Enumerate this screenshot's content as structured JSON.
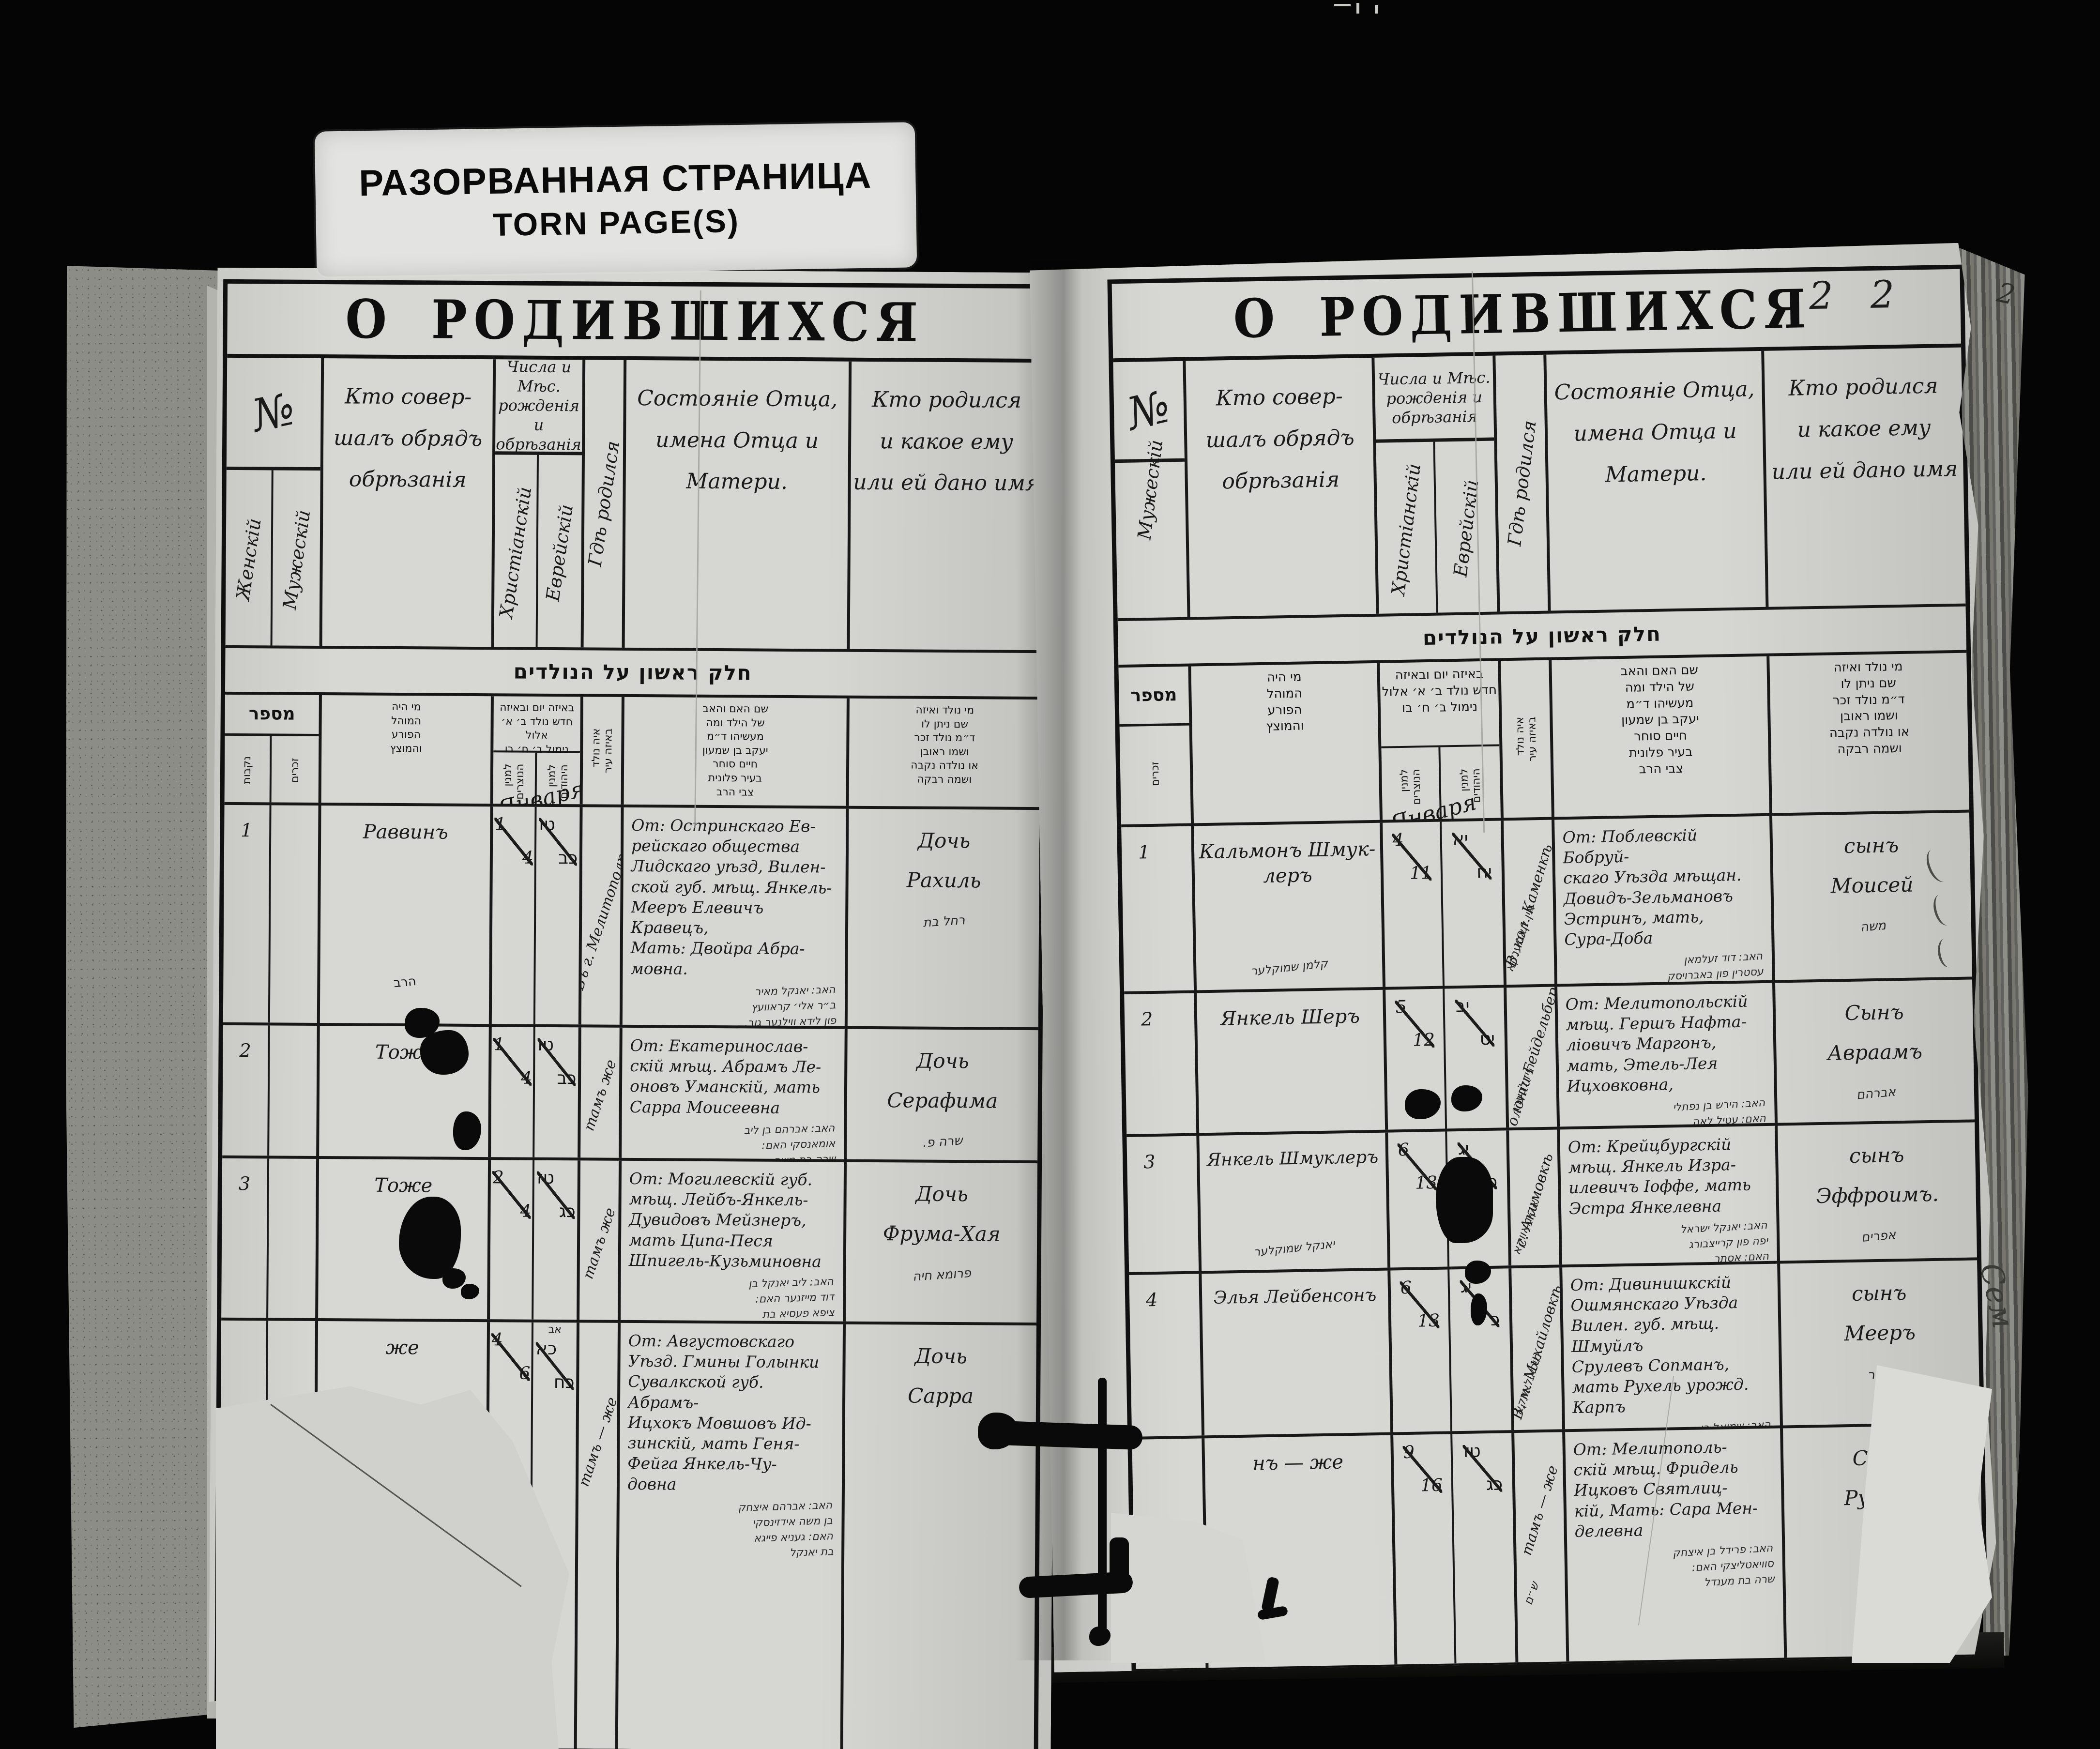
{
  "window_label": {
    "line1": "РАЗОРВАННАЯ СТРАНИЦА",
    "line2": "TORN PAGE(S)"
  },
  "titles": {
    "left": "О РОДИВШИХСЯ",
    "right": "О РОДИВШИХСЯ",
    "page_number": "2 2",
    "edge_number": "2",
    "margin_note": "Сем"
  },
  "columns": {
    "num_symbol": "№",
    "female": "Женскій",
    "male": "Мужескій",
    "performer": "Кто совер-\nшалъ обрядъ\nобрѣзанія",
    "dates": "Числа и Мѣс.\nрожденія и\nобрѣзанія",
    "date_christian": "Христіанскій",
    "date_jewish": "Еврейскій",
    "where": "Гдѣ родился",
    "parents": "Состояніе Отца,\nимена Отца и\nМатери.",
    "child": "Кто родился\nи какое ему\nили ей дано имя"
  },
  "hebrew": {
    "band": "חלק ראשון על הנולדים",
    "num": "מספר",
    "female": "נקבות",
    "male": "זכרים",
    "performer": "מי היה\nהמוהל\nהפורע\nוהמוצץ",
    "dates": "באיזה יום ובאיזה\nחדש נולד ב׳ א׳ אלול\nנימול ב׳ ח׳ בו",
    "chr": "למנין\nהנוצרים",
    "jew": "למנין\nהיהודים",
    "where": "איה נולד\nבאיזה עיר",
    "parents": "שם האם והאב\nשל הילד ומה\nמעשיהו ד״מ\nיעקב בן שמעון\nחיים סוחר\nבעיר פלונית\nצבי הרב",
    "child": "מי נולד ואיזה\nשם ניתן לו\nד״מ נולד זכר\nושמו ראובן\nאו נולדה נקבה\nושמה רבקה"
  },
  "months": {
    "left": "Января",
    "right": "Января"
  },
  "left_rows": [
    {
      "num": "1",
      "performer": "Раввинъ",
      "performer_note": "הרב",
      "chr_t": "1",
      "chr_b": "4",
      "jew_t": "טו",
      "jew_b": "כב",
      "where": "Въ г. Мелитополѣ",
      "parents": "От: Остринскаго Ев-\nрейскаго общества\nЛидскаго уѣзд, Вилен-\nской губ. мѣщ. Янкель-\nМееръ Елевичъ Кравецъ,\nМать: Двойра Абра-\nмовна.",
      "parents_yi": "האב: יאנקל מאיר\nב״ר אלי׳ קראוועץ\nפון לידא ווילנער גוב.\nהאם: דבורה בת אברהם",
      "child": "Дочь\nРахиль",
      "child_yi": "רחל בת"
    },
    {
      "num": "2",
      "performer": "Тоже",
      "chr_t": "1",
      "chr_b": "4",
      "jew_t": "טו",
      "jew_b": "כב",
      "where": "тамъ же",
      "parents": "От: Екатеринослав-\nскій мѣщ. Абрамъ Ле-\nоновъ Уманскій, мать\nСарра Моисеевна",
      "parents_yi": "האב: אברהם בן ליב\nאומאנסקי האם:\nשרה בת משה",
      "child": "Дочь\nСерафима",
      "child_yi": "שרה פ."
    },
    {
      "num": "3",
      "performer": "Тоже",
      "chr_t": "2",
      "chr_b": "4",
      "jew_t": "טז",
      "jew_b": "כג",
      "where": "тамъ же",
      "parents": "От: Могилевскій губ.\nмѣщ. Лейбъ-Янкель-\nДувидовъ Мейзнеръ,\nмать Ципа-Песя\nШпигель-Кузьминовна",
      "parents_yi": "האב: ליב יאנקל בן\nדוד מייזנער האם:\nציפא פעסיא בת\nשפיגל",
      "child": "Дочь\nФрума-Хая",
      "child_yi": "פרומא חיה"
    },
    {
      "num": "",
      "performer": "же",
      "chr_t": "4",
      "chr_b": "6",
      "jew_t": "כא",
      "jew_b": "כח",
      "jew_extra": "אב",
      "where": "тамъ — же",
      "parents": "От: Августовскаго\nУѣзд. Гмины Голынки\nСувалкской губ. Абрамъ-\nИцхокъ Мовшовъ Ид-\nзинскій, мать Геня-\nФейга Янкель-Чу-\nдовна",
      "parents_yi": "האב: אברהם איצחק\nבן משה אידזינסקי\nהאם: געניא פייגא\nבת יאנקל",
      "child": "Дочь\nСарра",
      "child_yi": ""
    }
  ],
  "right_rows": [
    {
      "num": "1",
      "performer": "Кальмонъ Шмук-\nлеръ",
      "performer_yi": "קלמן שמוקלער",
      "chr_t": "4",
      "chr_b": "11",
      "jew_t": "יא",
      "jew_b": "יח",
      "where": "В. кол. Каменкѣ",
      "where_yi": "אין קאמענקא",
      "parents": "От: Поблевскій Бобруй-\nскаго Уѣзда мѣщан.\nДовидъ-Зельмановъ\nЭстринъ, мать,\nСура-Доба",
      "parents_yi": "האב: דוד זעלמאן\nעסטרין פון באברויסק\nהאם: שרה דאבא",
      "child": "сынъ\nМоисей",
      "child_yi": "משה"
    },
    {
      "num": "2",
      "performer": "Янкель Шеръ",
      "chr_t": "5",
      "chr_b": "12",
      "jew_t": "יב",
      "jew_b": "יט",
      "where": "Колоніи Гейдельбер.",
      "where_yi": "היידלבערג",
      "parents": "От: Мелитопольскій\nмѣщ. Гершъ Нафта-\nліовичъ Маргонъ,\nмать, Этель-Лея\nИцховковна,",
      "parents_yi": "האב: הירש בן נפתלי\nהאם: עטיל לאה\nבת איצחק",
      "child": "Сынъ\nАвраамъ",
      "child_yi": "אברהם"
    },
    {
      "num": "3",
      "performer": "Янкель Шмуклеръ",
      "performer_yi": "יאנקל שמוקלער",
      "chr_t": "6",
      "chr_b": "13",
      "jew_t": "יג",
      "jew_b": "כ",
      "where": "с. Акимовкѣ",
      "where_yi": "אקימאווקא",
      "parents": "От: Крейцбургскій\nмѣщ. Янкель Изра-\nилевичъ Іоффе, мать\nЭстра Янкелевна",
      "parents_yi": "האב: יאנקל ישראל\nיפה פון קרייצבורג\nהאם: אסתר",
      "child": "сынъ\nЭффроимъ.",
      "child_yi": "אפרים"
    },
    {
      "num": "4",
      "performer": "Элья Лейбенсонъ",
      "chr_t": "6",
      "chr_b": "13",
      "jew_t": "יג",
      "jew_b": "כ",
      "where": "В. м. Михайловкѣ",
      "where_yi": "מיכאילאווקא",
      "parents": "От: Дивинишкскій\nОшмянскаго Уѣзда\nВилен. губ. мѣщ. Шмуйлъ\nСрулевъ Сопманъ,\nмать Рухель урожд. Карпъ",
      "parents_yi": "האב: שמואל בן\nישראל זאפמאן\nהאם: רחל קארפ",
      "child": "сынъ\nМееръ",
      "child_yi": "מאיר"
    },
    {
      "num": "",
      "performer": "нъ — же",
      "chr_t": "9",
      "chr_b": "16",
      "jew_t": "טז",
      "jew_b": "כג",
      "where": "тамъ — же",
      "where_yi": "ש״ם",
      "parents": "От: Мелитополь-\nскій мѣщ. Фридель\nИцковъ Святлиц-\nкій, Мать: Сара Мен-\nделевна",
      "parents_yi": "האב: פרידל בן איצחק\nסוויאטליצקי האם:\nשרה בת מענדל",
      "child": "Сынъ\nРувинъ",
      "child_yi": "ראובן"
    }
  ]
}
